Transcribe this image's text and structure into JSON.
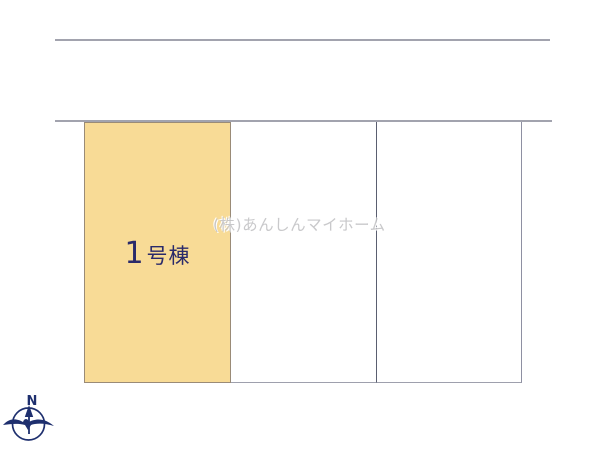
{
  "canvas": {
    "width": 600,
    "height": 449,
    "background": "#ffffff"
  },
  "lots": [
    {
      "id": "lot-1",
      "number": "1",
      "suffix": "号棟",
      "label": "1号棟",
      "fill": "#f8db96",
      "label_color": "#2a2a6a"
    },
    {
      "id": "lot-2",
      "label": "",
      "fill": "#ffffff"
    },
    {
      "id": "lot-3",
      "label": "",
      "fill": "#ffffff"
    }
  ],
  "watermark": {
    "text": "(株)あんしんマイホーム",
    "color": "#c3c3c5"
  },
  "compass": {
    "north_label": "N",
    "color": "#1e2f6e"
  },
  "colors": {
    "road_line": "#a2a3ae",
    "lot_highlight_border": "#9a8b77",
    "divider_dark": "#5a5e70",
    "outer_border": "#8e90a2",
    "bottom_border": "#9ea0ad"
  }
}
